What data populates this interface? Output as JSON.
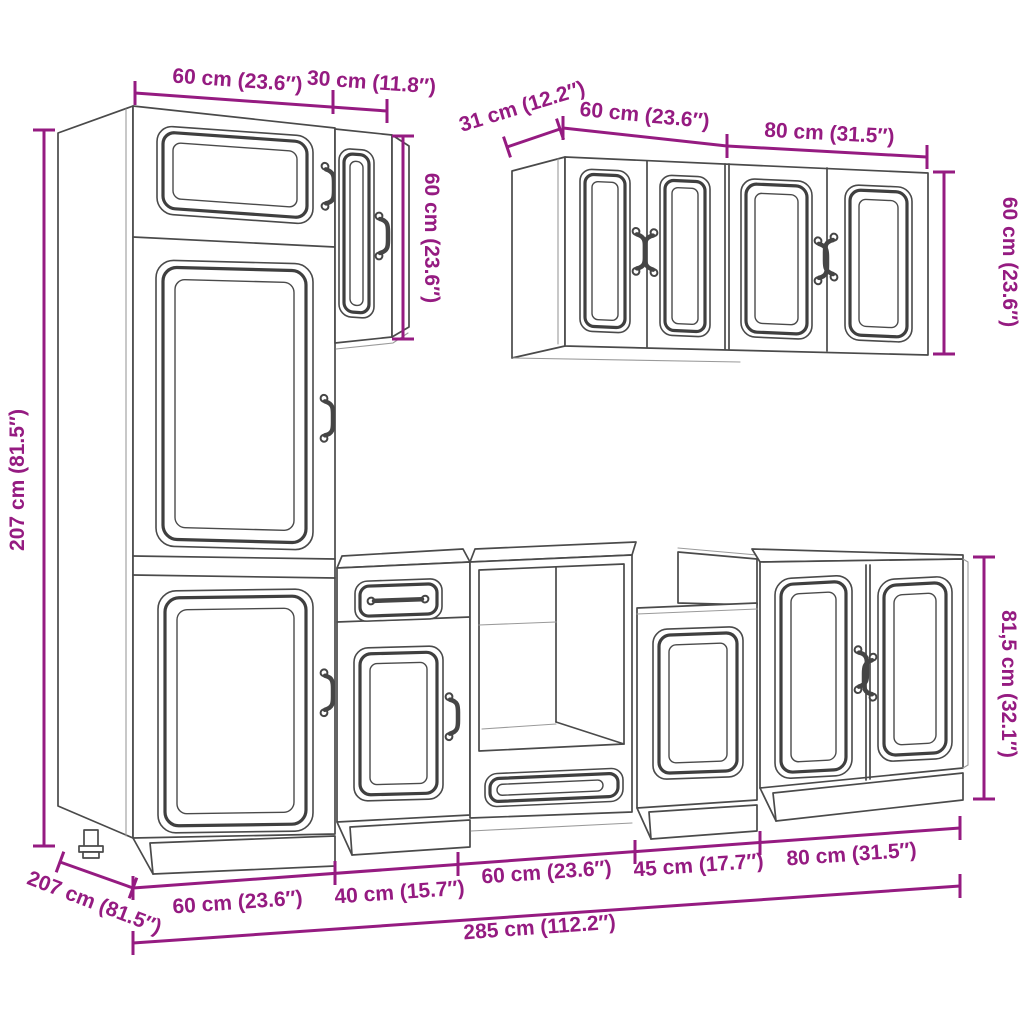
{
  "diagram": {
    "kind": "kitchen-cabinet-set-dimension-drawing",
    "colors": {
      "dimension": "#951B81",
      "line": "#4a4a4a",
      "background": "#ffffff"
    }
  },
  "dim_labels": {
    "tall_cabinet_width": "60 cm (23.6″)",
    "upper_cabinet_width": "30 cm (11.8″)",
    "upper_cabinet_height": "60 cm (23.6″)",
    "wall_cabinet_depth": "31 cm (12.2″)",
    "wall_cabinet_60_width": "60 cm (23.6″)",
    "wall_cabinet_80_width": "80 cm (31.5″)",
    "wall_cabinet_height": "60 cm (23.6″)",
    "tall_cabinet_height": "207 cm (81.5″)",
    "base_cabinet_height": "81,5 cm (32.1″)",
    "base_unit_1_width": "60 cm (23.6″)",
    "base_unit_2_width": "40 cm (15.7″)",
    "base_unit_3_width": "60 cm (23.6″)",
    "base_unit_4_width": "45 cm (17.7″)",
    "base_unit_5_width": "80 cm (31.5″)",
    "total_width": "285 cm (112.2″)",
    "floor_depth": "207 cm (81.5″)"
  }
}
